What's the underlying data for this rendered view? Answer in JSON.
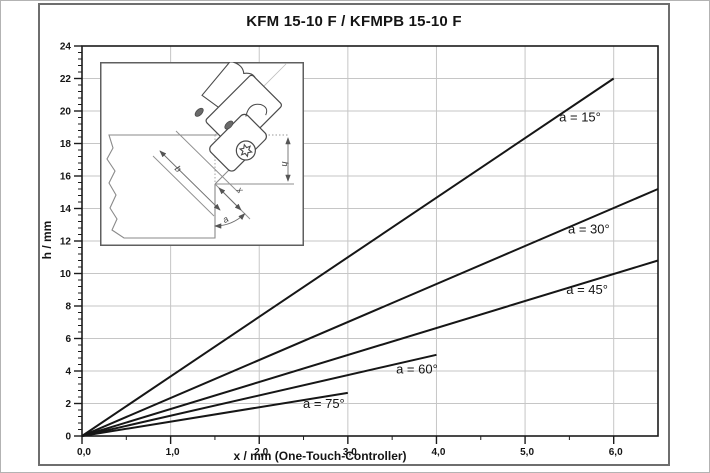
{
  "figure": {
    "title": "KFM 15-10 F / KFMPB 15-10 F"
  },
  "chart_data": {
    "type": "line",
    "title": "KFM 15-10 F / KFMPB 15-10 F",
    "xlabel": "x / mm (One-Touch-Controller)",
    "ylabel": "h / mm",
    "xlim": [
      0,
      6.5
    ],
    "ylim": [
      0,
      24
    ],
    "x_major_ticks": [
      0,
      1,
      2,
      3,
      4,
      5,
      6
    ],
    "x_tick_labels": [
      "0,0",
      "1,0",
      "2,0",
      "3,0",
      "4,0",
      "5,0",
      "6,0"
    ],
    "x_minor_step": 0.5,
    "y_major_ticks": [
      0,
      2,
      4,
      6,
      8,
      10,
      12,
      14,
      16,
      18,
      20,
      22,
      24
    ],
    "y_minor_step": 0.4,
    "grid": {
      "major": true,
      "minor": false,
      "color": "#c6c6c6"
    },
    "legend_position": "labels-on-lines",
    "line_color": "#161616",
    "series": [
      {
        "name": "a = 15°",
        "angle_deg": 15,
        "points": [
          [
            0,
            0
          ],
          [
            6.0,
            22.0
          ]
        ],
        "label_xy": [
          5.62,
          19.35
        ]
      },
      {
        "name": "a = 30°",
        "angle_deg": 30,
        "points": [
          [
            0,
            0
          ],
          [
            6.5,
            15.2
          ]
        ],
        "label_xy": [
          5.72,
          12.45
        ]
      },
      {
        "name": "a = 45°",
        "angle_deg": 45,
        "points": [
          [
            0,
            0
          ],
          [
            6.5,
            10.8
          ]
        ],
        "label_xy": [
          5.7,
          8.75
        ]
      },
      {
        "name": "a = 60°",
        "angle_deg": 60,
        "points": [
          [
            0,
            0
          ],
          [
            4.0,
            5.0
          ]
        ],
        "label_xy": [
          3.78,
          3.85
        ]
      },
      {
        "name": "a = 75°",
        "angle_deg": 75,
        "points": [
          [
            0,
            0
          ],
          [
            3.0,
            2.65
          ]
        ],
        "label_xy": [
          2.73,
          1.72
        ]
      }
    ]
  },
  "inset": {
    "dim_labels": {
      "b": "b",
      "x": "x",
      "h": "h",
      "a": "a"
    }
  }
}
